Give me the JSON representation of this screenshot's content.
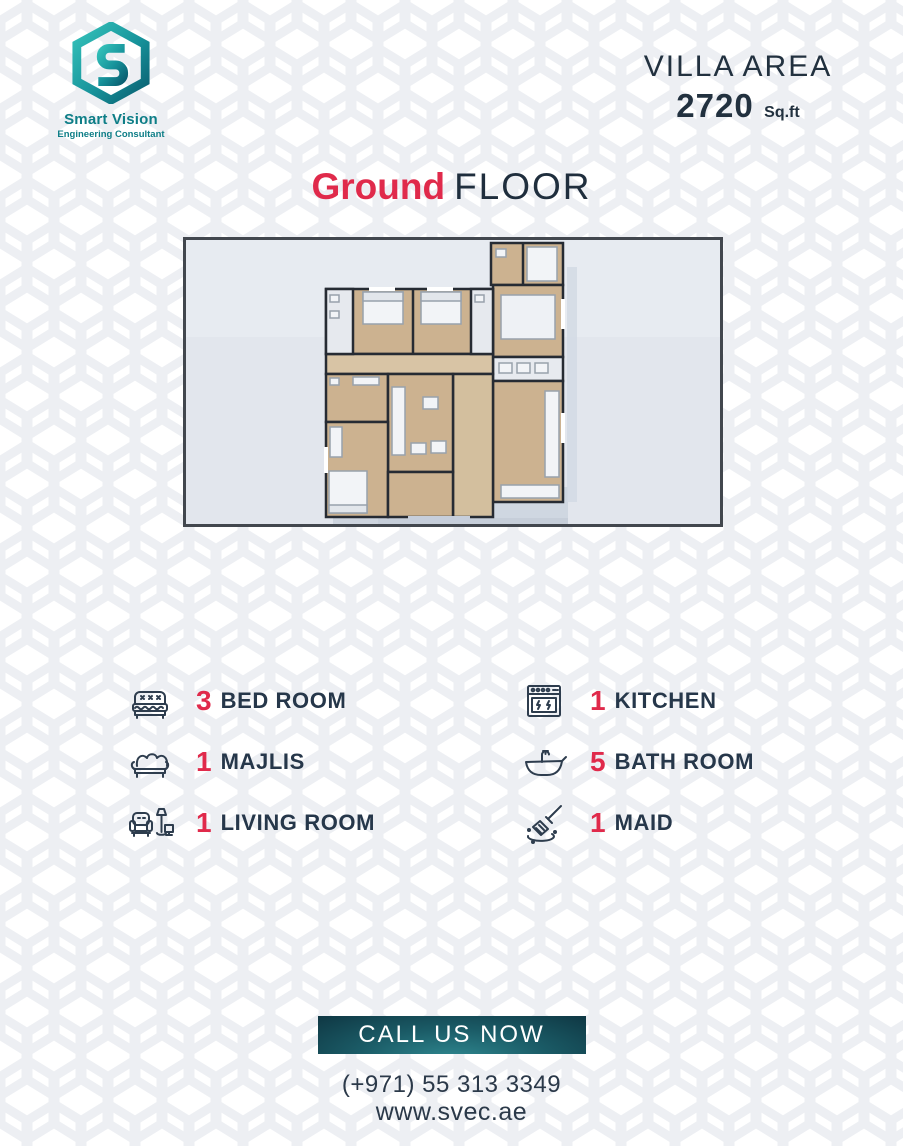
{
  "brand": {
    "name": "Smart Vision",
    "tagline": "Engineering Consultant"
  },
  "villa_area": {
    "label": "VILLA AREA",
    "value": "2720",
    "unit": "Sq.ft"
  },
  "title": {
    "highlight": "Ground",
    "rest": "FLOOR"
  },
  "floor_plan": {
    "description": "3D top-view render of villa ground floor plan"
  },
  "features": {
    "left": [
      {
        "icon": "bed-icon",
        "count": "3",
        "label": "BED ROOM"
      },
      {
        "icon": "majlis-sofa-icon",
        "count": "1",
        "label": "MAJLIS"
      },
      {
        "icon": "armchair-lamp-tv-icon",
        "count": "1",
        "label": "LIVING ROOM"
      }
    ],
    "right": [
      {
        "icon": "stove-icon",
        "count": "1",
        "label": "KITCHEN"
      },
      {
        "icon": "bathtub-icon",
        "count": "5",
        "label": "BATH ROOM"
      },
      {
        "icon": "cleaning-brush-icon",
        "count": "1",
        "label": "MAID"
      }
    ]
  },
  "cta": {
    "label": "CALL US NOW"
  },
  "contact": {
    "phone": "(+971) 55 313 3349",
    "website": "www.svec.ae"
  },
  "colors": {
    "accent_red": "#E02A4B",
    "navy": "#26374A",
    "teal": "#0E7E87",
    "button_gradient_dark": "#0F3844",
    "button_gradient_light": "#2F8890"
  }
}
